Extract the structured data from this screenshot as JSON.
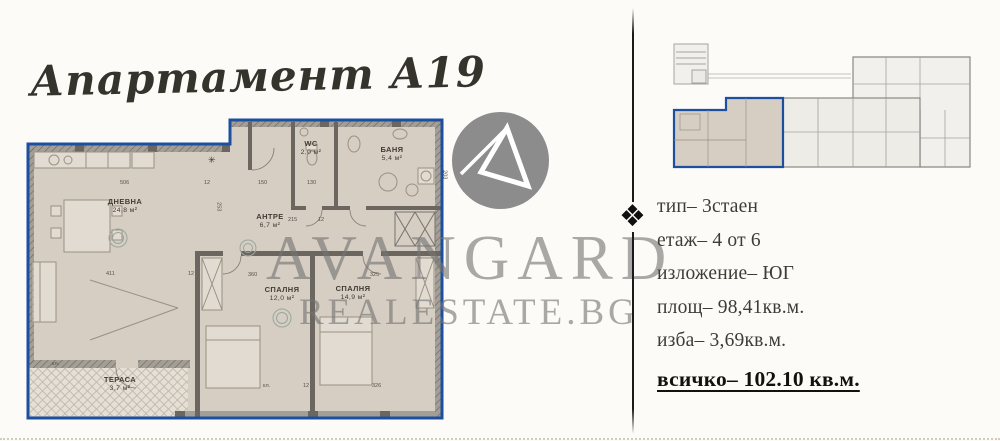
{
  "page": {
    "background": "#fcfbf7",
    "accent_blue": "#1d4fa1"
  },
  "header": {
    "title": "Апартамент А19"
  },
  "watermark": {
    "brand": "AVANGARD",
    "domain": "REALESTATE.BG",
    "logo_icon": "avangard-circle-a-logo",
    "gray": "#8c8c8c"
  },
  "icons": {
    "move": "❖"
  },
  "floorplan": {
    "floor_fill": "#d6cdc3",
    "terrace_fill": "#e5dfd5",
    "outline_blue": "#1d4fa1",
    "star_mark": "✳",
    "rooms": [
      {
        "name": "ДНЕВНА",
        "area": "24,8 м²"
      },
      {
        "name": "WC",
        "area": "2,0 м²"
      },
      {
        "name": "БАНЯ",
        "area": "5,4 м²"
      },
      {
        "name": "АНТРЕ",
        "area": "6,7 м²"
      },
      {
        "name": "СПАЛНЯ",
        "area": "12,0 м²"
      },
      {
        "name": "СПАЛНЯ",
        "area": "14,9 м²"
      },
      {
        "name": "ТЕРАСА",
        "area": "3,7 м²"
      }
    ],
    "dimensions": [
      {
        "t": "506",
        "x": 100,
        "y": 69
      },
      {
        "t": "12",
        "x": 184,
        "y": 69
      },
      {
        "t": "150",
        "x": 238,
        "y": 69
      },
      {
        "t": "130",
        "x": 287,
        "y": 69
      },
      {
        "t": "215",
        "x": 268,
        "y": 106
      },
      {
        "t": "12",
        "x": 298,
        "y": 106
      },
      {
        "t": "411",
        "x": 86,
        "y": 160
      },
      {
        "t": "12",
        "x": 168,
        "y": 160
      },
      {
        "t": "360",
        "x": 228,
        "y": 161
      },
      {
        "t": "325",
        "x": 350,
        "y": 161
      },
      {
        "t": "253",
        "x": 193,
        "y": 92,
        "rot": 1
      },
      {
        "t": "203",
        "x": 419,
        "y": 60,
        "rot": 1
      },
      {
        "t": "кл.",
        "x": 243,
        "y": 272
      },
      {
        "t": "12",
        "x": 283,
        "y": 272
      },
      {
        "t": "326",
        "x": 352,
        "y": 272
      },
      {
        "t": "кл.",
        "x": 32,
        "y": 250
      }
    ]
  },
  "details": {
    "lines": [
      "тип– 3стаен",
      "етаж– 4 от 6",
      "изложение– ЮГ",
      "площ– 98,41кв.м.",
      "изба– 3,69кв.м."
    ],
    "total": "всичко– 102.10 кв.м."
  }
}
